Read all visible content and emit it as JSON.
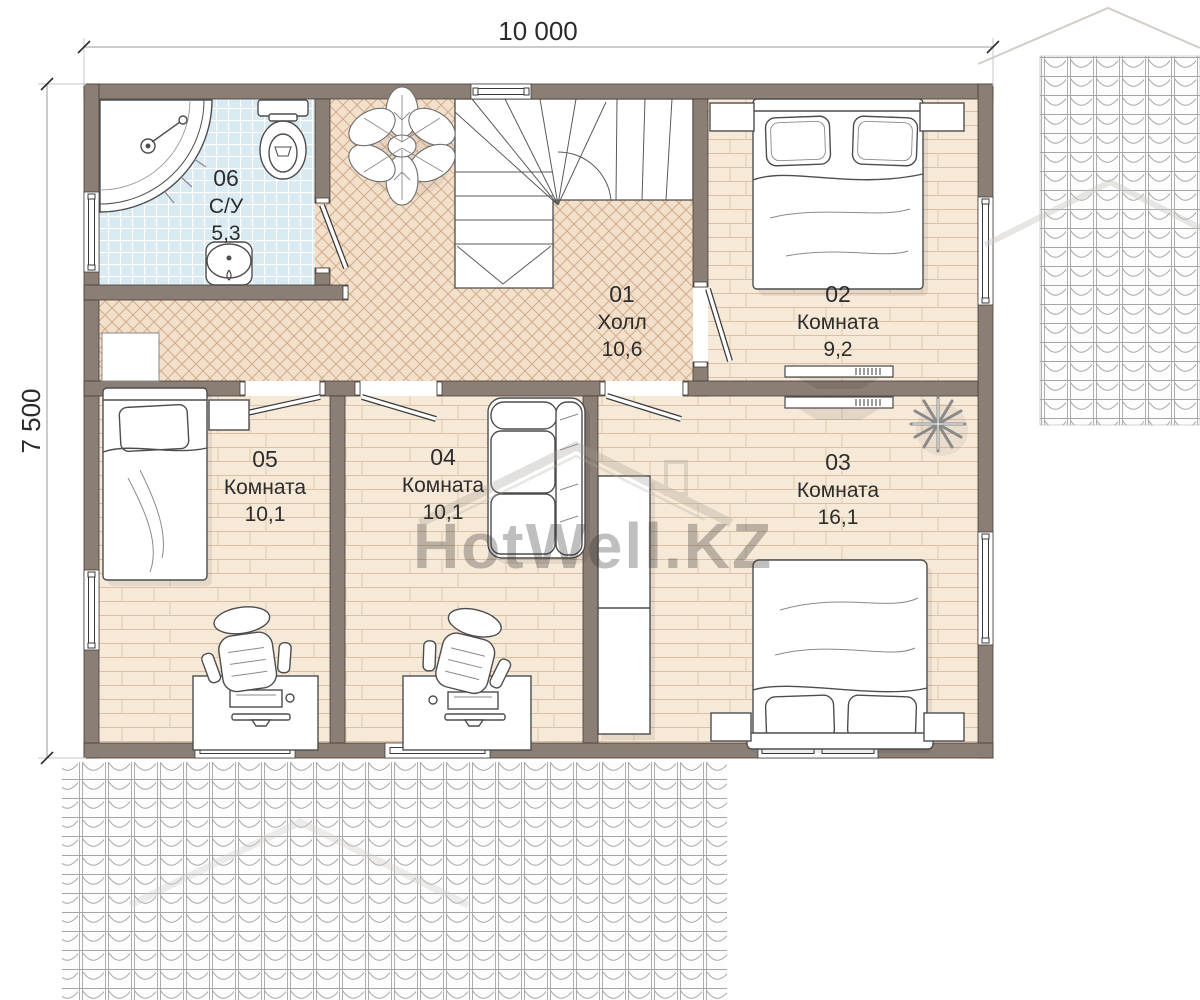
{
  "dimensions": {
    "width_label": "10 000",
    "height_label": "7 500"
  },
  "watermark": {
    "text": "HotWell.KZ"
  },
  "rooms": [
    {
      "number": "01",
      "name": "Холл",
      "area": "10,6"
    },
    {
      "number": "02",
      "name": "Комната",
      "area": "9,2"
    },
    {
      "number": "03",
      "name": "Комната",
      "area": "16,1"
    },
    {
      "number": "04",
      "name": "Комната",
      "area": "10,1"
    },
    {
      "number": "05",
      "name": "Комната",
      "area": "10,1"
    },
    {
      "number": "06",
      "name": "С/У",
      "area": "5,3"
    }
  ],
  "colors": {
    "wall": "#8b7e74",
    "wall_outline": "#453e38",
    "floor_plank": "#f7e9d8",
    "floor_parquet": "#f3e0cb",
    "floor_tile": "#d9eaf3",
    "roof_line": "#a0a0a0",
    "furniture_stroke": "#4d4d4d",
    "text": "#2d2d2d"
  }
}
